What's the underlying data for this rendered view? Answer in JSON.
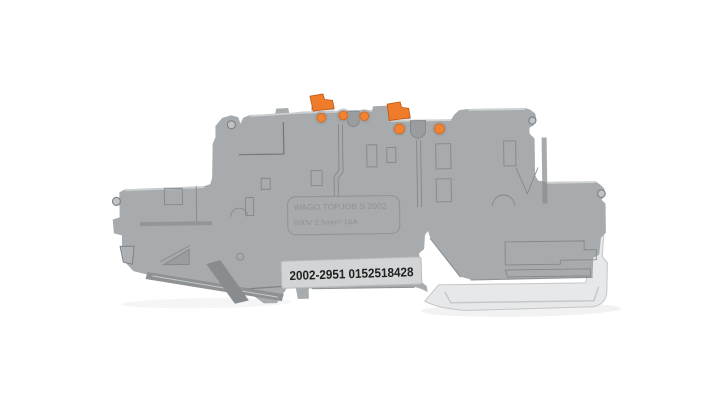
{
  "window": {
    "width": 720,
    "height": 407
  },
  "product_photo": {
    "subject": "double-deck push-in DIN rail terminal block",
    "markings": {
      "brand_line": "WAGO TOPJOB S 2002",
      "rating_line": "600V 2,5mm² 16A",
      "order_number": "2002-2951 0152518428"
    },
    "features": {
      "push_levers": 2,
      "test_points": 5,
      "mounting_holes": 4,
      "wire_notches": 2
    },
    "colors": {
      "background": "#ffffff",
      "body": "#a8abad",
      "body_highlight": "#d2d5d6",
      "body_shadow": "#85888a",
      "recess": "#898c8e",
      "foot": "#e7e8e9",
      "lever_orange": "#f07c2b",
      "lever_edge": "#c05512",
      "test_point_orange": "#f08232",
      "label_background": "#d2d4d5",
      "label_text": "#202020",
      "embossed_text": "#8f9294"
    }
  }
}
